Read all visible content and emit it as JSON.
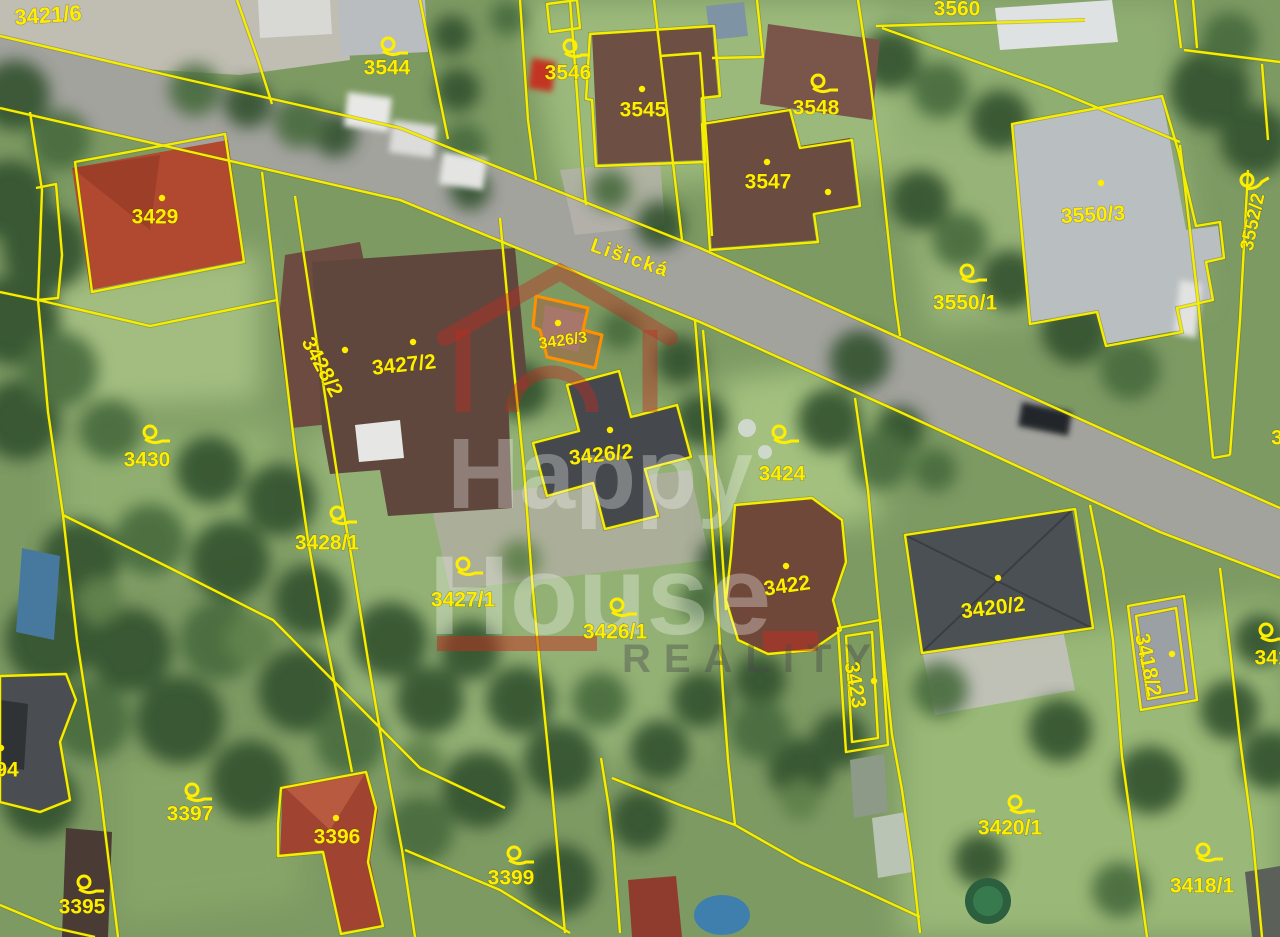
{
  "map": {
    "street_label": "Lišická",
    "selected_parcel": "3426/3",
    "colors": {
      "boundary_yellow": "#f6ee00",
      "selected_orange": "#ff8c00",
      "label_yellow": "#ffee00",
      "watermark_red": "#c12d1e",
      "road_gray": "#a3a39e"
    },
    "watermark": {
      "line1": "Happy",
      "line2": "House",
      "line3": "REALITY"
    },
    "parcels": [
      {
        "label": "3421/6",
        "x": 48,
        "y": 15,
        "rot": -4,
        "size": 22,
        "marker": "none"
      },
      {
        "label": "3544",
        "x": 387,
        "y": 68,
        "rot": 0,
        "marker": "flag",
        "mx": 388,
        "my": 44
      },
      {
        "label": "3546",
        "x": 568,
        "y": 73,
        "rot": 0,
        "marker": "flag",
        "mx": 570,
        "my": 46
      },
      {
        "label": "3545",
        "x": 643,
        "y": 110,
        "rot": 0,
        "marker": "dot",
        "mx": 642,
        "my": 89
      },
      {
        "label": "3548",
        "x": 816,
        "y": 108,
        "rot": 0,
        "marker": "flag",
        "mx": 818,
        "my": 81
      },
      {
        "label": "3547",
        "x": 768,
        "y": 182,
        "rot": 0,
        "marker": "dot",
        "mx": 767,
        "my": 162
      },
      {
        "label": "3560",
        "x": 957,
        "y": 9,
        "rot": 0,
        "marker": "none"
      },
      {
        "label": "3550/3",
        "x": 1093,
        "y": 215,
        "rot": -3,
        "marker": "dot",
        "mx": 1101,
        "my": 183
      },
      {
        "label": "3552/2",
        "x": 1253,
        "y": 222,
        "rot": -78,
        "size": 19,
        "marker": "flag",
        "mx": 1247,
        "my": 180,
        "mrot": -30
      },
      {
        "label": "3550/1",
        "x": 965,
        "y": 303,
        "rot": 0,
        "marker": "flag",
        "mx": 967,
        "my": 271
      },
      {
        "label": "3429",
        "x": 155,
        "y": 217,
        "rot": 0,
        "marker": "dot",
        "mx": 162,
        "my": 198
      },
      {
        "label": "3430",
        "x": 147,
        "y": 460,
        "rot": 0,
        "marker": "flag",
        "mx": 150,
        "my": 432
      },
      {
        "label": "3428/2",
        "x": 322,
        "y": 367,
        "rot": 62,
        "marker": "dot",
        "mx": 345,
        "my": 350
      },
      {
        "label": "3427/2",
        "x": 404,
        "y": 365,
        "rot": -6,
        "marker": "dot",
        "mx": 413,
        "my": 342
      },
      {
        "label": "3426/3",
        "x": 563,
        "y": 341,
        "rot": -8,
        "size": 16,
        "marker": "dot",
        "mx": 558,
        "my": 323
      },
      {
        "label": "3426/2",
        "x": 601,
        "y": 455,
        "rot": -6,
        "marker": "dot",
        "mx": 610,
        "my": 430
      },
      {
        "label": "3424",
        "x": 782,
        "y": 474,
        "rot": 0,
        "marker": "flag",
        "mx": 779,
        "my": 432
      },
      {
        "label": "3428/1",
        "x": 327,
        "y": 543,
        "rot": 0,
        "marker": "flag",
        "mx": 337,
        "my": 513
      },
      {
        "label": "3427/1",
        "x": 463,
        "y": 600,
        "rot": 0,
        "marker": "flag",
        "mx": 463,
        "my": 564
      },
      {
        "label": "3426/1",
        "x": 615,
        "y": 632,
        "rot": 0,
        "marker": "flag",
        "mx": 617,
        "my": 605
      },
      {
        "label": "3422",
        "x": 787,
        "y": 586,
        "rot": -8,
        "marker": "dot",
        "mx": 786,
        "my": 566
      },
      {
        "label": "3420/2",
        "x": 993,
        "y": 608,
        "rot": -7,
        "marker": "dot",
        "mx": 998,
        "my": 578
      },
      {
        "label": "3423",
        "x": 855,
        "y": 685,
        "rot": 80,
        "marker": "dot",
        "mx": 874,
        "my": 681
      },
      {
        "label": "3418/2",
        "x": 1148,
        "y": 665,
        "rot": 78,
        "marker": "dot",
        "mx": 1172,
        "my": 654
      },
      {
        "label": "341",
        "x": 1272,
        "y": 658,
        "rot": 0,
        "marker": "flag",
        "mx": 1266,
        "my": 630
      },
      {
        "label": "3397",
        "x": 190,
        "y": 814,
        "rot": 0,
        "marker": "flag",
        "mx": 192,
        "my": 790
      },
      {
        "label": "3396",
        "x": 337,
        "y": 837,
        "rot": 0,
        "marker": "dot",
        "mx": 336,
        "my": 818
      },
      {
        "label": "3395",
        "x": 82,
        "y": 907,
        "rot": 0,
        "marker": "flag",
        "mx": 84,
        "my": 882
      },
      {
        "label": "94",
        "x": 7,
        "y": 770,
        "rot": 0,
        "marker": "dot",
        "mx": 1,
        "my": 748
      },
      {
        "label": "3399",
        "x": 511,
        "y": 878,
        "rot": 0,
        "marker": "flag",
        "mx": 514,
        "my": 853
      },
      {
        "label": "3420/1",
        "x": 1010,
        "y": 828,
        "rot": 0,
        "marker": "flag",
        "mx": 1015,
        "my": 802
      },
      {
        "label": "3418/1",
        "x": 1202,
        "y": 886,
        "rot": 0,
        "marker": "flag",
        "mx": 1203,
        "my": 850
      },
      {
        "label": "3",
        "x": 1277,
        "y": 438,
        "rot": 0,
        "marker": "none"
      }
    ],
    "extra_markers": [
      {
        "type": "dot",
        "x": 828,
        "y": 192
      }
    ]
  }
}
